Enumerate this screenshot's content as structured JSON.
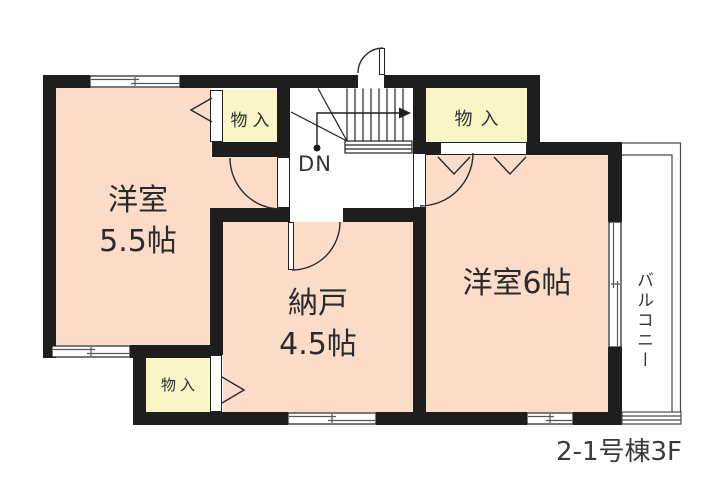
{
  "caption": "2-1号棟3F",
  "rooms": {
    "west_room_55": {
      "name": "洋室",
      "size": "5.5帖"
    },
    "storage_room": {
      "name": "納戸",
      "size": "4.5帖"
    },
    "west_room_6": {
      "name": "洋室6帖"
    }
  },
  "closets": {
    "top_left": {
      "label": "物入"
    },
    "top_right": {
      "label": "物入"
    },
    "bottom_left": {
      "label": "物入"
    }
  },
  "stairs": {
    "label": "DN"
  },
  "balcony": {
    "label": "バルコニー"
  },
  "colors": {
    "wall": "#1e1e1e",
    "room_fill": "#fadcc9",
    "closet_fill": "#f9f5c6",
    "line": "#2a2a2a"
  }
}
